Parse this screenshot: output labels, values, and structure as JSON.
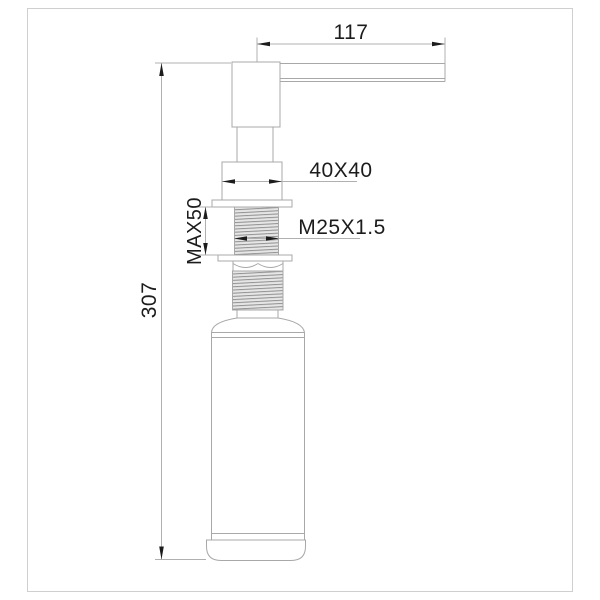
{
  "dimensions": {
    "spout_reach": "117",
    "overall_height": "307",
    "body_section": "40X40",
    "thread": "M25X1.5",
    "max_mount_thickness": "MAX50"
  },
  "colors": {
    "background": "#ffffff",
    "frame": "#cfcfcf",
    "outline": "#a8a8a8",
    "dimension_line": "#b0b0b0",
    "ink": "#1c1c1c",
    "thread_fill": "#e6e6e6",
    "thread_line": "#8f8f8f"
  }
}
